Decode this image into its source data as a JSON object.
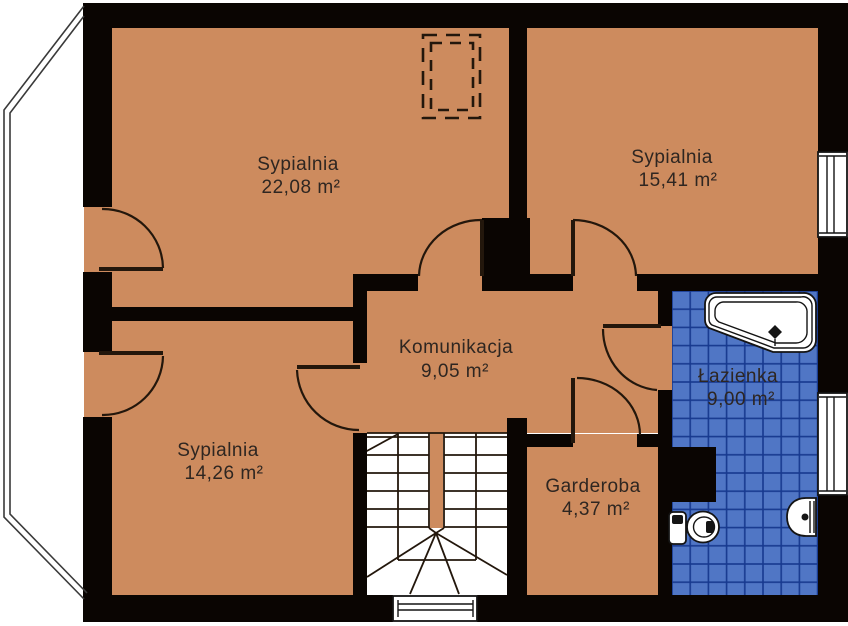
{
  "plan": {
    "type": "floor-plan",
    "language": "pl",
    "rooms": [
      {
        "id": "sypialnia-1",
        "label": "Sypialnia",
        "area": "22,08 m²"
      },
      {
        "id": "sypialnia-2",
        "label": "Sypialnia",
        "area": "15,41 m²"
      },
      {
        "id": "komunikacja",
        "label": "Komunikacja",
        "area": "9,05 m²"
      },
      {
        "id": "sypialnia-3",
        "label": "Sypialnia",
        "area": "14,26 m²"
      },
      {
        "id": "garderoba",
        "label": "Garderoba",
        "area": "4,37 m²"
      },
      {
        "id": "lazienka",
        "label": "Łazienka",
        "area": "9,00 m²"
      }
    ],
    "colors": {
      "floor": "#cd8b5e",
      "wall": "#0a0502",
      "tile": "#5076c5",
      "tile_grid": "#17398f",
      "line": "#23170c",
      "text": "#2e2621"
    }
  }
}
